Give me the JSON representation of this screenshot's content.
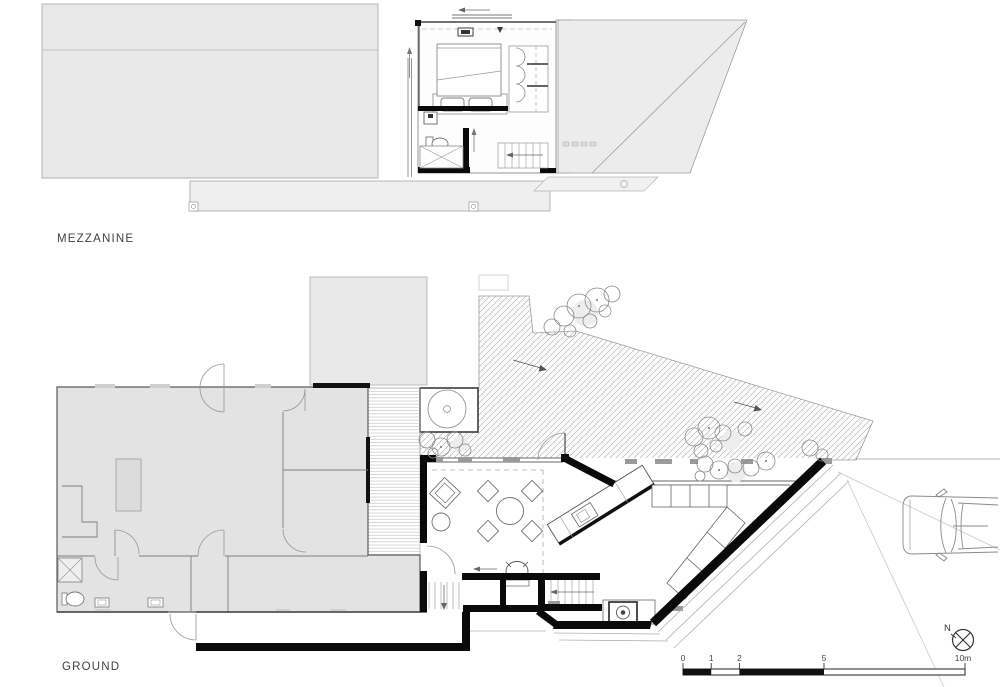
{
  "document": {
    "type": "architectural floor plan drawing",
    "sheet_background": "#ffffff"
  },
  "plans": [
    {
      "id": "mezzanine",
      "label": "MEZZANINE"
    },
    {
      "id": "ground",
      "label": "GROUND"
    }
  ],
  "north_arrow": {
    "label": "N"
  },
  "scale_bar": {
    "labels": [
      "0",
      "1",
      "2",
      "5",
      "10m"
    ],
    "values_m": [
      0,
      1,
      2,
      5,
      10
    ],
    "style": "alternating black and white bar"
  },
  "colors": {
    "paper": "#ffffff",
    "roof_fill": "#ececec",
    "existing_building_fill": "#e3e3e3",
    "deck_fill": "#f2f2f2",
    "hatch_line": "#9a9a9a",
    "thin_line": "#8a8a8a",
    "new_wall_black": "#0a0a0a",
    "text": "#3a3a3a"
  }
}
